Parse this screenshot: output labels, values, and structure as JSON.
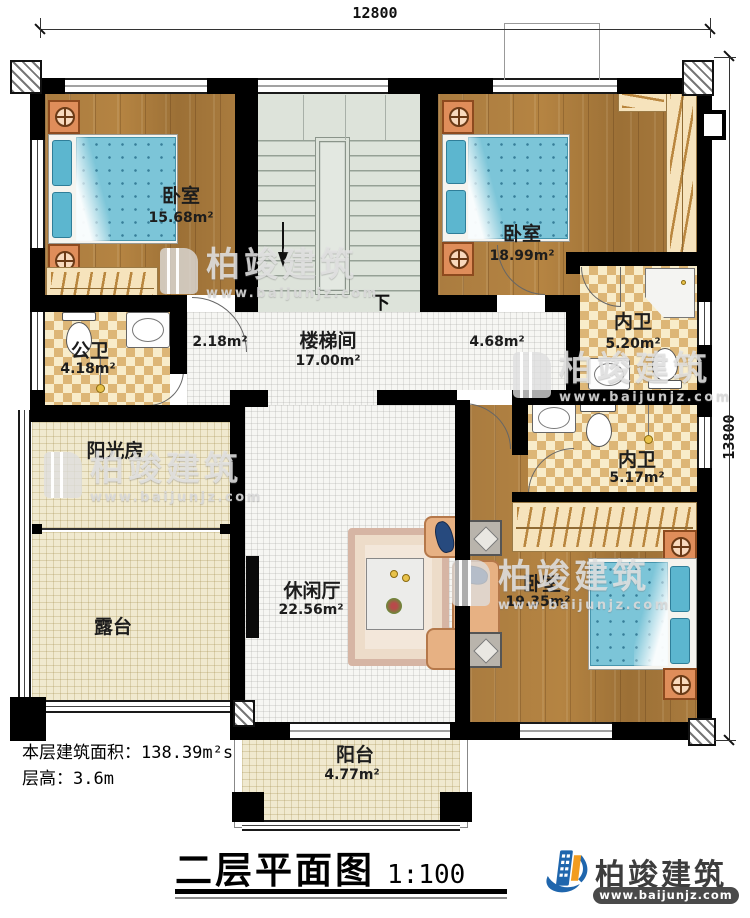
{
  "dimensions": {
    "top": "12800",
    "right": "13800"
  },
  "rooms": {
    "bedroom_top_left": {
      "name": "卧室",
      "area": "15.68m²"
    },
    "bedroom_top_right": {
      "name": "卧室",
      "area": "18.99m²"
    },
    "ensuite_top": {
      "name": "内卫",
      "area": "5.20m²"
    },
    "public_bath": {
      "name": "公卫",
      "area": "4.18m²"
    },
    "stairwell": {
      "name": "楼梯间",
      "area": "17.00m²"
    },
    "corridor_left": {
      "area": "2.18m²"
    },
    "corridor_right": {
      "area": "4.68m²"
    },
    "ensuite_mid": {
      "name": "内卫",
      "area": "5.17m²"
    },
    "sunroom": {
      "name": "阳光房"
    },
    "terrace": {
      "name": "露台"
    },
    "lounge": {
      "name": "休闲厅",
      "area": "22.56m²"
    },
    "bedroom_bottom": {
      "name": "卧室",
      "area": "19.35m²"
    },
    "balcony": {
      "name": "阳台",
      "area": "4.77m²"
    }
  },
  "stairs": {
    "down_label": "下"
  },
  "notes": {
    "area_line": "本层建筑面积：138.39m²s",
    "height_line": "层高：3.6m"
  },
  "titleblock": {
    "title": "二层平面图",
    "scale": "1:100"
  },
  "brand": {
    "name": "柏竣建筑",
    "url": "www.baijunjz.com",
    "blue": "#1f66ad",
    "orange": "#f29c1f"
  },
  "watermark": {
    "name": "柏竣建筑",
    "url": "www.baijunjz.com"
  }
}
